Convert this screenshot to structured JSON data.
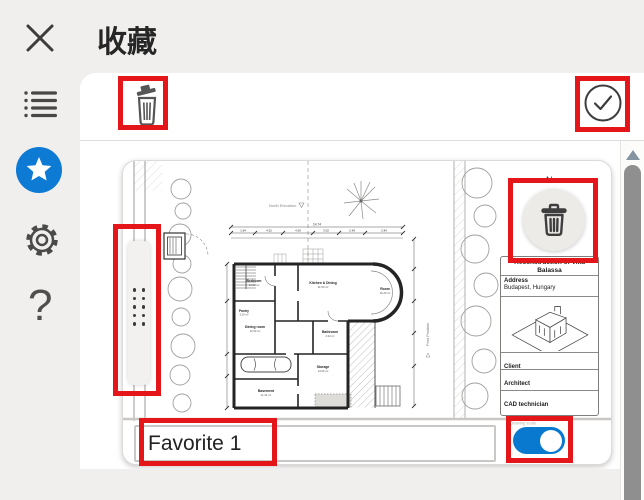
{
  "header": {
    "title": "收藏"
  },
  "sidebar": {
    "icons": [
      {
        "name": "close-icon"
      },
      {
        "name": "list-icon"
      },
      {
        "name": "star-icon",
        "active": true
      },
      {
        "name": "gear-icon"
      },
      {
        "name": "help-icon",
        "glyph": "?"
      }
    ]
  },
  "toolbar": {
    "icons": [
      {
        "name": "trash-icon"
      },
      {
        "name": "check-circle-icon"
      }
    ]
  },
  "favorite_card": {
    "name_value": "Favorite 1",
    "visibility_toggle_on": true,
    "drawing": {
      "north_label": "N",
      "elevation_note": "North Elevation",
      "plot_note": "Post Position",
      "scale_note": "Drawing scale",
      "dim_total": "14.74",
      "dimensions": [
        "1.84",
        "4.52",
        "4.50",
        "3.02",
        "2.48",
        "2.84"
      ],
      "rooms": [
        {
          "label": "Bedroom",
          "area": "14.00 m²"
        },
        {
          "label": "Kitchen & Dining",
          "area": "21.50 m²"
        },
        {
          "label": "Room",
          "area": "16.40 m²"
        },
        {
          "label": "Pantry",
          "area": "3.20 m²"
        },
        {
          "label": "Dining room",
          "area": "12.60 m²"
        },
        {
          "label": "Bathroom",
          "area": "4.34 m²"
        },
        {
          "label": "Storage",
          "area": "14.00 m²"
        },
        {
          "label": "Basement",
          "area": "11.34 m²"
        }
      ],
      "title_block": {
        "title": "Reconstruction of Villa Balassa",
        "address_label": "Address",
        "address_value": "Budapest, Hungary",
        "client_label": "Client",
        "architect_label": "Architect",
        "cad_label": "CAD technician"
      }
    }
  },
  "colors": {
    "accent_blue": "#0d7ad4",
    "toggle_on_blue": "#0879cf",
    "highlight_red": "#e5161a"
  }
}
